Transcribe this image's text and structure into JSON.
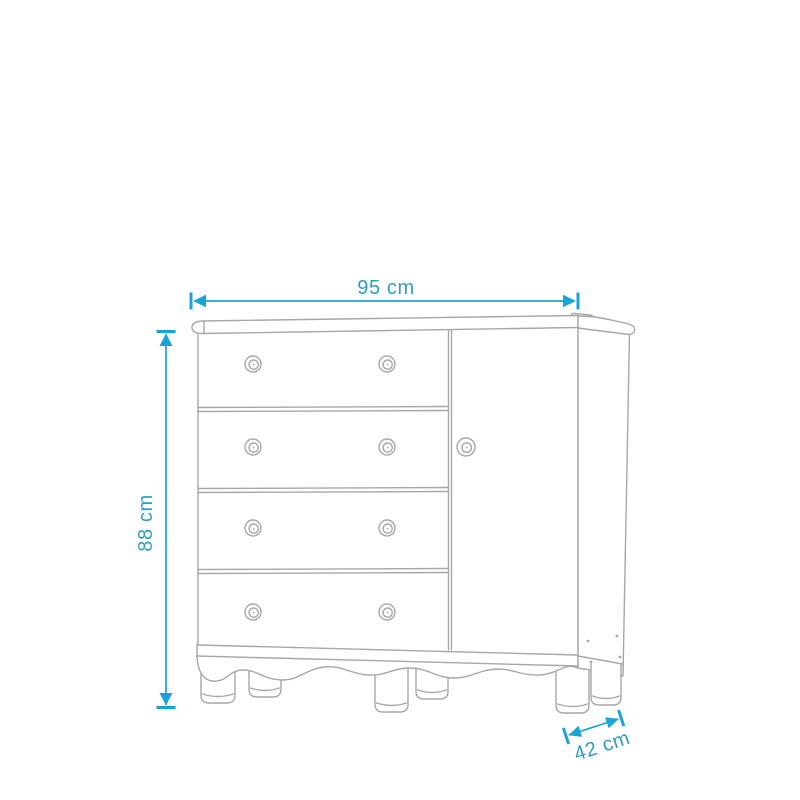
{
  "diagram": {
    "type": "furniture-dimension-diagram",
    "subject": "dresser with four drawers, side door, scalloped apron and round feet",
    "unit": "cm",
    "dimensions": {
      "width": {
        "value": 95,
        "label": "95 cm"
      },
      "height": {
        "value": 88,
        "label": "88 cm"
      },
      "depth": {
        "value": 42,
        "label": "42 cm"
      }
    },
    "furniture": {
      "drawer_count": 4,
      "knobs_per_drawer": 2,
      "door_count": 1,
      "door_knob_count": 1,
      "feet_count": 6
    },
    "colors": {
      "dimension_text": "#2F9DC3",
      "dimension_arrow": "#18A4D6",
      "outline": "#A7A7A7",
      "background": "#FFFFFF"
    }
  }
}
